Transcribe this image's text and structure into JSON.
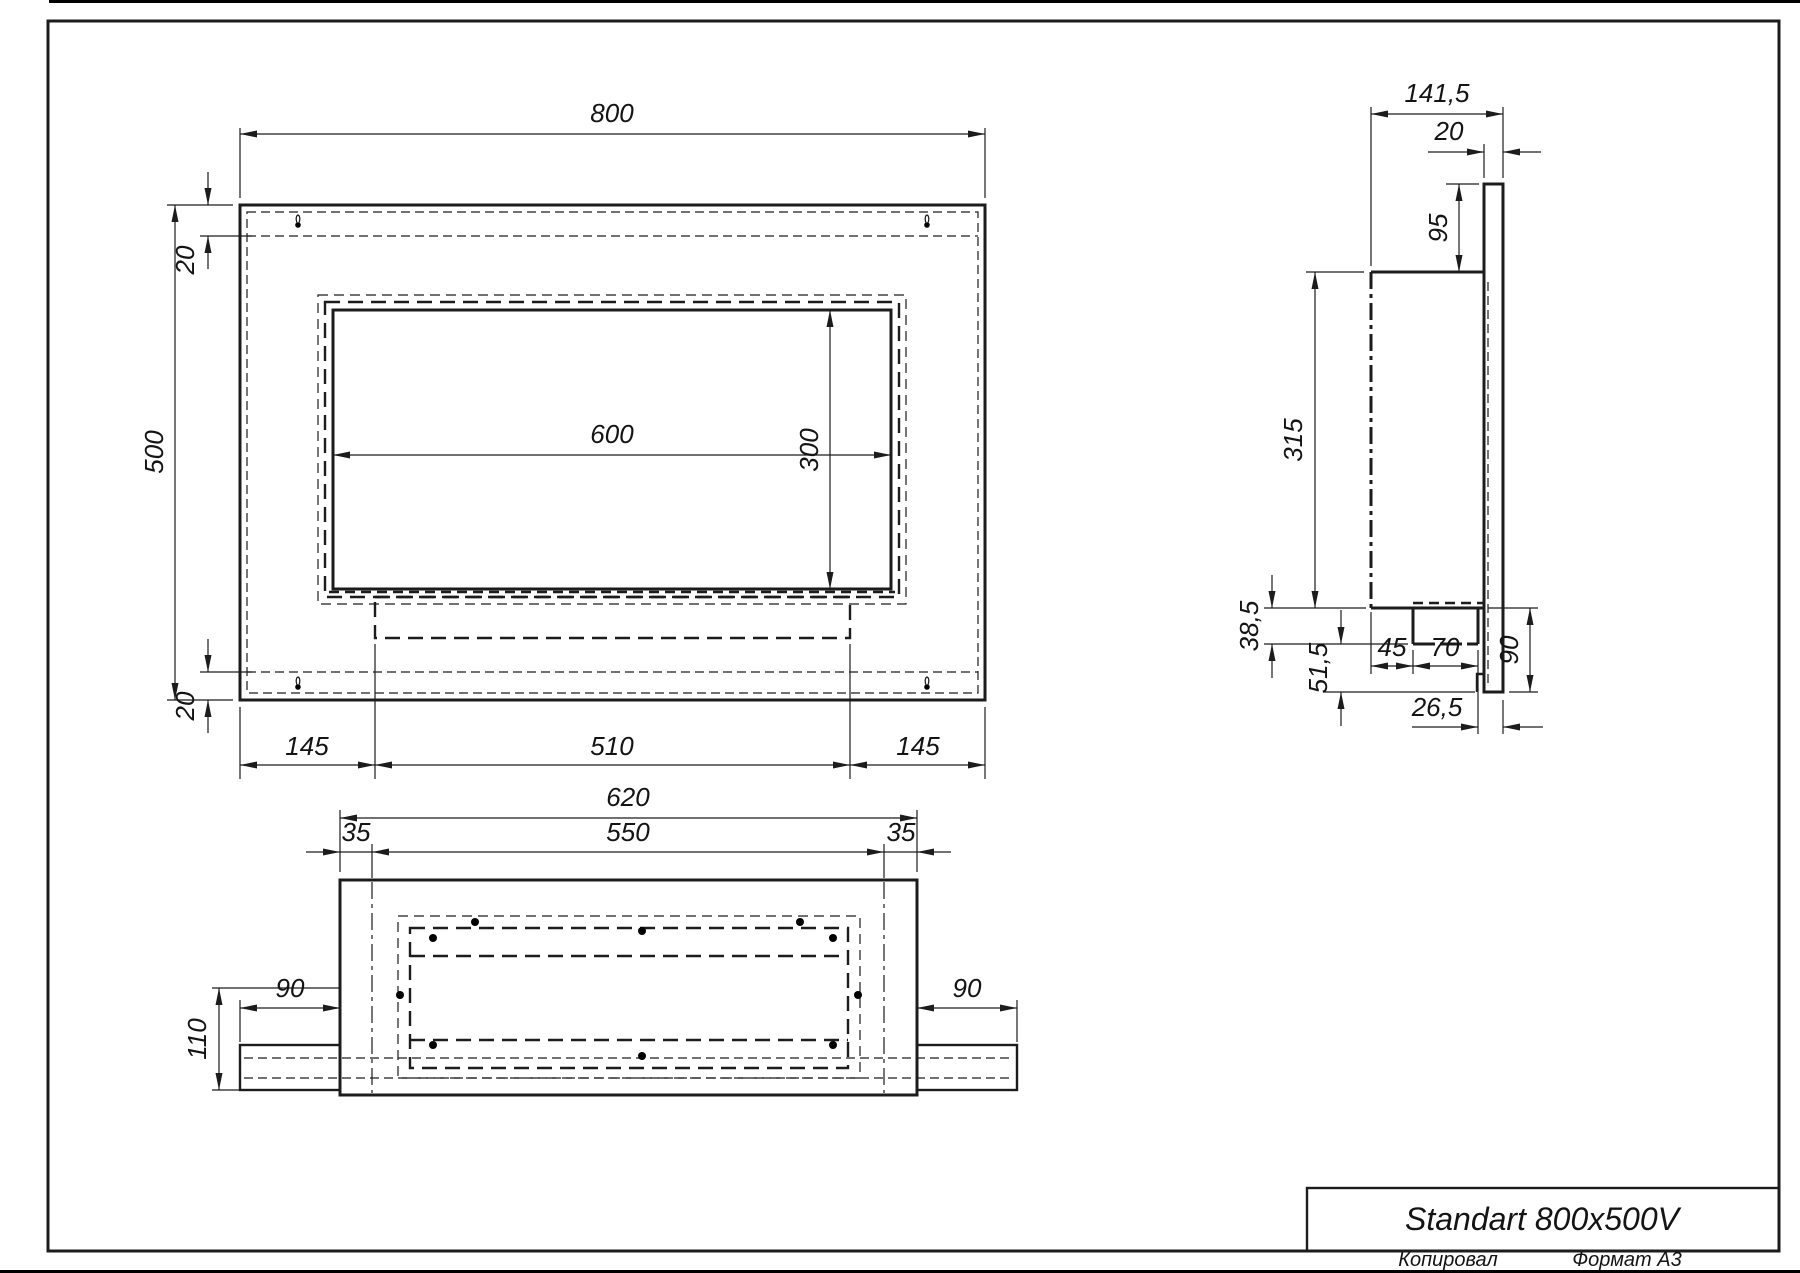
{
  "page": {
    "title": "Standart 800x500V",
    "copied_label": "Копировал",
    "format_label": "Формат А3"
  },
  "front_view": {
    "width": "800",
    "height": "500",
    "fold_top": "20",
    "fold_bottom": "20",
    "opening_width": "600",
    "opening_height": "300",
    "margin_left": "145",
    "tray_width": "510",
    "margin_right": "145"
  },
  "side_view": {
    "depth": "141,5",
    "plate_thickness": "20",
    "top_offset": "95",
    "body_height": "315",
    "tray_depth": "38,5",
    "lower_gap": "51,5",
    "tray_front_offset": "45",
    "tray_width": "70",
    "hook_height": "90",
    "back_offset": "26,5"
  },
  "bottom_view": {
    "panel_width": "620",
    "inner_width": "550",
    "fold_left": "35",
    "fold_right": "35",
    "depth": "110",
    "wing_left": "90",
    "wing_right": "90"
  }
}
